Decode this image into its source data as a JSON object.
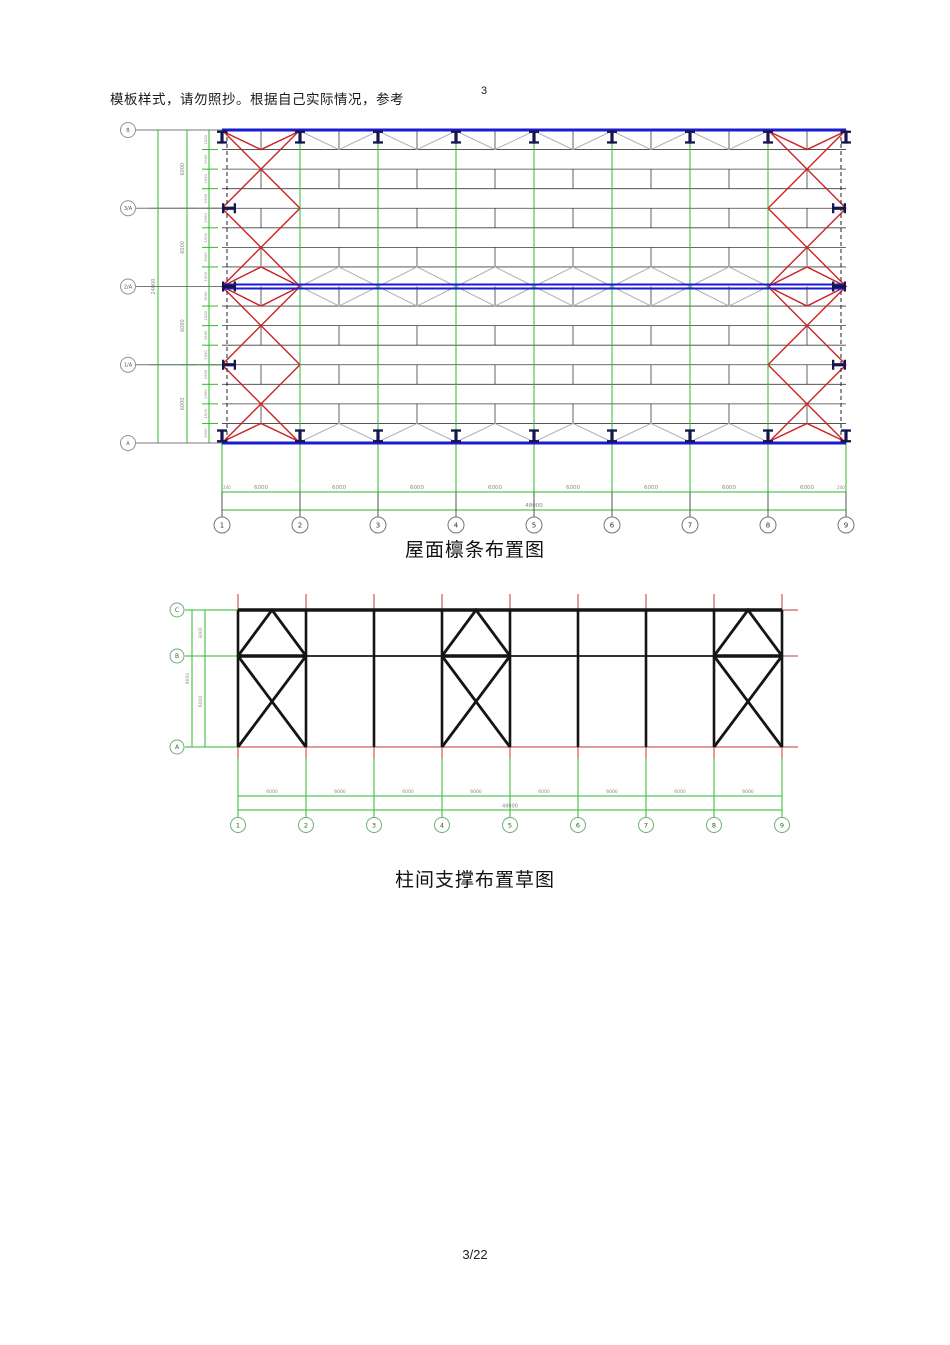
{
  "page": {
    "header_note": "模板样式，请勿照抄。根据自己实际情况，参考",
    "header_number": "3",
    "footer_page": "3/22"
  },
  "colors": {
    "green": "#2eb82e",
    "blue": "#1b1bd0",
    "brace_red": "#cc2424",
    "grid_red": "#c03a3a",
    "steel_navy": "#15154f",
    "frame_black": "#151515",
    "gray_tie": "#b0b0b0",
    "dim_text": "#7f8f7f"
  },
  "roof_plan": {
    "caption": "屋面檩条布置图",
    "row_axes": [
      "B",
      "3/A",
      "2/A",
      "1/A",
      "A"
    ],
    "col_axes": [
      "1",
      "2",
      "3",
      "4",
      "5",
      "6",
      "7",
      "8",
      "9"
    ],
    "bay_dims": [
      "6000",
      "6000",
      "6000",
      "6000",
      "6000",
      "6000",
      "6000",
      "6000"
    ],
    "end_dims": [
      "240",
      "240"
    ],
    "total_dim": "48000",
    "left_span_dims": [
      "6000",
      "6000",
      "6000",
      "6000"
    ],
    "left_total_dim": "24000",
    "purlin_dims": [
      "1500",
      "1500",
      "1500",
      "1500",
      "1500",
      "1500",
      "1500",
      "1500",
      "1500",
      "1500",
      "1500",
      "1500",
      "1500",
      "1500",
      "1500",
      "1500"
    ]
  },
  "bracing_sketch": {
    "caption": "柱间支撑布置草图",
    "row_axes": [
      "C",
      "B",
      "A"
    ],
    "col_axes": [
      "1",
      "2",
      "3",
      "4",
      "5",
      "6",
      "7",
      "8",
      "9"
    ],
    "bay_dims": [
      "6000",
      "6000",
      "6000",
      "6000",
      "6000",
      "6000",
      "6000",
      "6000"
    ],
    "total_dim": "48000",
    "left_span_dims": [
      "3000",
      "6000"
    ],
    "left_total_dim": "9000"
  }
}
